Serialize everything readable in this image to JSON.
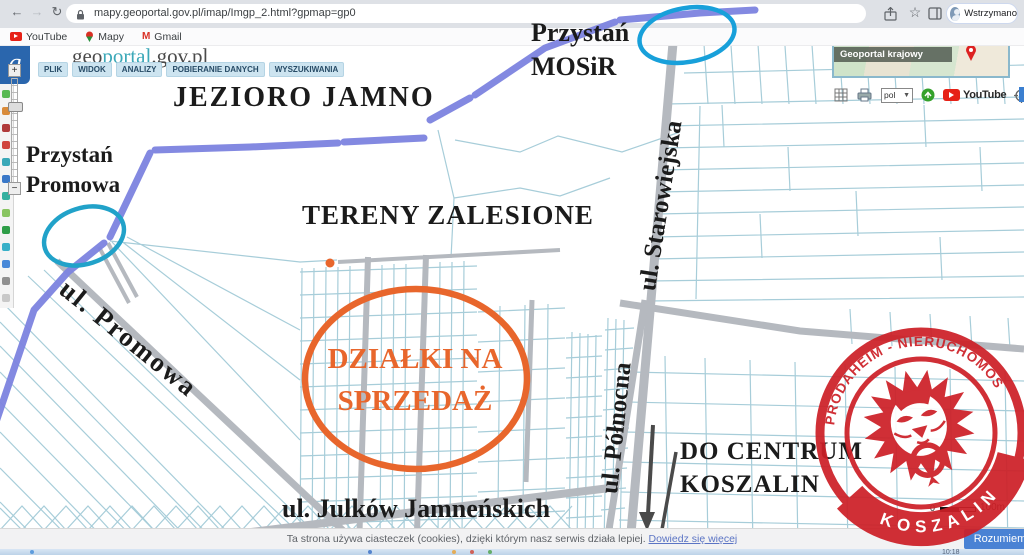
{
  "browser": {
    "url": "mapy.geoportal.gov.pl/imap/Imgp_2.html?gpmap=gp0",
    "profile_label": "Wstrzymano",
    "bookmarks": [
      "YouTube",
      "Mapy",
      "Gmail"
    ]
  },
  "geoportal": {
    "logo": {
      "g": "g",
      "prefix": "geo",
      "highlight": "portal",
      "suffix": ".gov.pl"
    },
    "menu": [
      "PLIK",
      "WIDOK",
      "ANALIZY",
      "POBIERANIE DANYCH",
      "WYSZUKIWANIA"
    ],
    "minimap_label": "Geoportal krajowy",
    "language_select": "pol",
    "youtube_label": "YouTube",
    "zoom_in": "+",
    "zoom_out": "−",
    "scale": {
      "zero": "0",
      "max": "100m"
    }
  },
  "annotations": {
    "lake": "JEZIORO JAMNO",
    "pier_mosir": [
      "Przystań",
      "MOSiR"
    ],
    "pier_promowa": [
      "Przystań",
      "Promowa"
    ],
    "forest": "TERENY ZALESIONE",
    "plots": [
      "DZIAŁKI NA",
      "SPRZEDAŻ"
    ],
    "street_promowa": "ul. Promowa",
    "street_polnocna": "ul. Północna",
    "street_starowiejska": "ul. Starowiejska",
    "street_julkow": "ul. Julków Jamneńskich",
    "to_center": [
      "DO CENTRUM",
      "KOSZALIN"
    ]
  },
  "stamp": {
    "arc_text": "PRODAHEIM - NIERUCHOMOŚCI",
    "banner_text": "KOSZALIN"
  },
  "cookie_bar": {
    "message": "Ta strona używa ciasteczek (cookies), dzięki którym nasz serwis działa lepiej.",
    "link_label": "Dowiedz się więcej",
    "accept_label": "Rozumiem"
  },
  "taskbar": {
    "clock": "10:18"
  },
  "colors": {
    "stamp_red": "#cd2027",
    "annotation_orange": "#e8662c",
    "shoreline_purple": "#7c83df",
    "ellipse_blue": "#18a0da",
    "ellipse_teal": "#21a2c9",
    "parcel_teal": "#a7cdd9",
    "road_gray": "#b5b9bf",
    "accept_blue": "#4a82d4",
    "youtube_red": "#e62117",
    "label_black": "#1b1b1b"
  }
}
